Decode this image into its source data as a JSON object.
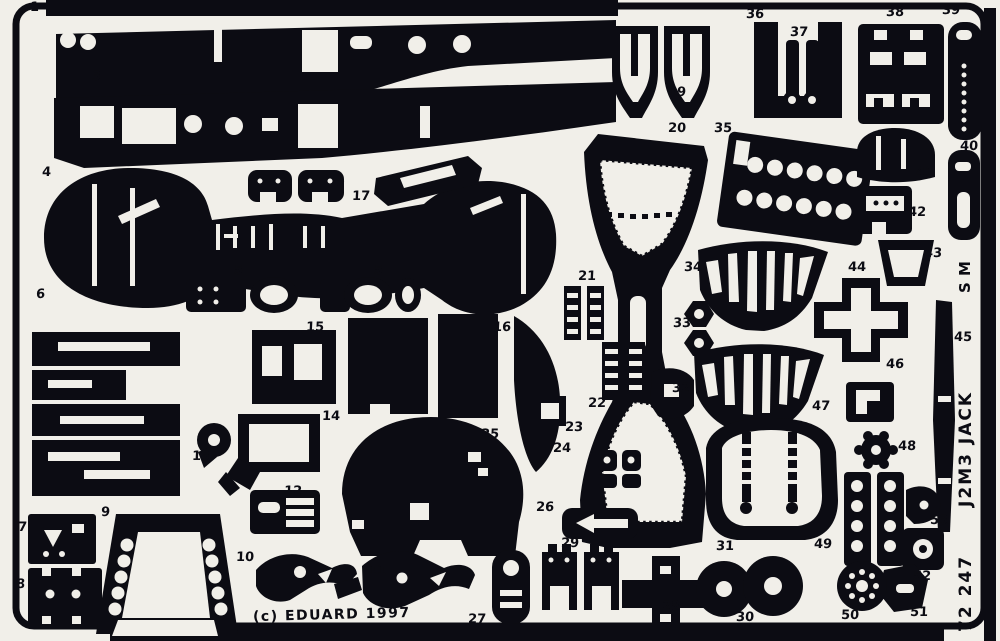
{
  "sheet": {
    "copyright": "(c) EDUARD 1997",
    "code": "72 247",
    "subject": "J2M3 JACK",
    "monogram_lines": [
      "M",
      "S"
    ],
    "colors": {
      "ink": "#0c0c13",
      "paper": "#f1efe9"
    }
  },
  "parts": [
    {
      "num": "1",
      "x": 30,
      "y": 1
    },
    {
      "num": "3",
      "x": 92,
      "y": 70
    },
    {
      "num": "2",
      "x": 336,
      "y": 178
    },
    {
      "num": "17",
      "x": 352,
      "y": 190
    },
    {
      "num": "4",
      "x": 42,
      "y": 166
    },
    {
      "num": "5",
      "x": 234,
      "y": 264
    },
    {
      "num": "5",
      "x": 374,
      "y": 264
    },
    {
      "num": "6",
      "x": 36,
      "y": 288
    },
    {
      "num": "19",
      "x": 668,
      "y": 86
    },
    {
      "num": "36",
      "x": 746,
      "y": 8
    },
    {
      "num": "37",
      "x": 790,
      "y": 26
    },
    {
      "num": "38",
      "x": 886,
      "y": 6
    },
    {
      "num": "39",
      "x": 942,
      "y": 4
    },
    {
      "num": "20",
      "x": 668,
      "y": 122
    },
    {
      "num": "35",
      "x": 714,
      "y": 122
    },
    {
      "num": "40",
      "x": 960,
      "y": 140
    },
    {
      "num": "41",
      "x": 916,
      "y": 166
    },
    {
      "num": "42",
      "x": 908,
      "y": 206
    },
    {
      "num": "43",
      "x": 924,
      "y": 247
    },
    {
      "num": "44",
      "x": 848,
      "y": 261
    },
    {
      "num": "34",
      "x": 684,
      "y": 261
    },
    {
      "num": "33",
      "x": 673,
      "y": 317
    },
    {
      "num": "21",
      "x": 578,
      "y": 270
    },
    {
      "num": "15",
      "x": 306,
      "y": 321
    },
    {
      "num": "16",
      "x": 493,
      "y": 321
    },
    {
      "num": "32",
      "x": 672,
      "y": 382
    },
    {
      "num": "22",
      "x": 588,
      "y": 397
    },
    {
      "num": "23",
      "x": 565,
      "y": 421
    },
    {
      "num": "24",
      "x": 553,
      "y": 442
    },
    {
      "num": "46",
      "x": 886,
      "y": 358
    },
    {
      "num": "45",
      "x": 954,
      "y": 331
    },
    {
      "num": "47",
      "x": 812,
      "y": 400
    },
    {
      "num": "48",
      "x": 898,
      "y": 440
    },
    {
      "num": "13",
      "x": 192,
      "y": 450
    },
    {
      "num": "14",
      "x": 322,
      "y": 410
    },
    {
      "num": "25",
      "x": 481,
      "y": 428
    },
    {
      "num": "26",
      "x": 536,
      "y": 501
    },
    {
      "num": "12",
      "x": 284,
      "y": 485
    },
    {
      "num": "31",
      "x": 716,
      "y": 540
    },
    {
      "num": "49",
      "x": 814,
      "y": 538
    },
    {
      "num": "53",
      "x": 930,
      "y": 514
    },
    {
      "num": "52",
      "x": 913,
      "y": 570
    },
    {
      "num": "7",
      "x": 18,
      "y": 521
    },
    {
      "num": "8",
      "x": 16,
      "y": 578
    },
    {
      "num": "9",
      "x": 101,
      "y": 506
    },
    {
      "num": "10",
      "x": 236,
      "y": 551
    },
    {
      "num": "11",
      "x": 368,
      "y": 564
    },
    {
      "num": "27",
      "x": 468,
      "y": 613
    },
    {
      "num": "29",
      "x": 561,
      "y": 537
    },
    {
      "num": "28",
      "x": 662,
      "y": 600
    },
    {
      "num": "30",
      "x": 736,
      "y": 611
    },
    {
      "num": "50",
      "x": 841,
      "y": 609
    },
    {
      "num": "51",
      "x": 910,
      "y": 606
    }
  ]
}
